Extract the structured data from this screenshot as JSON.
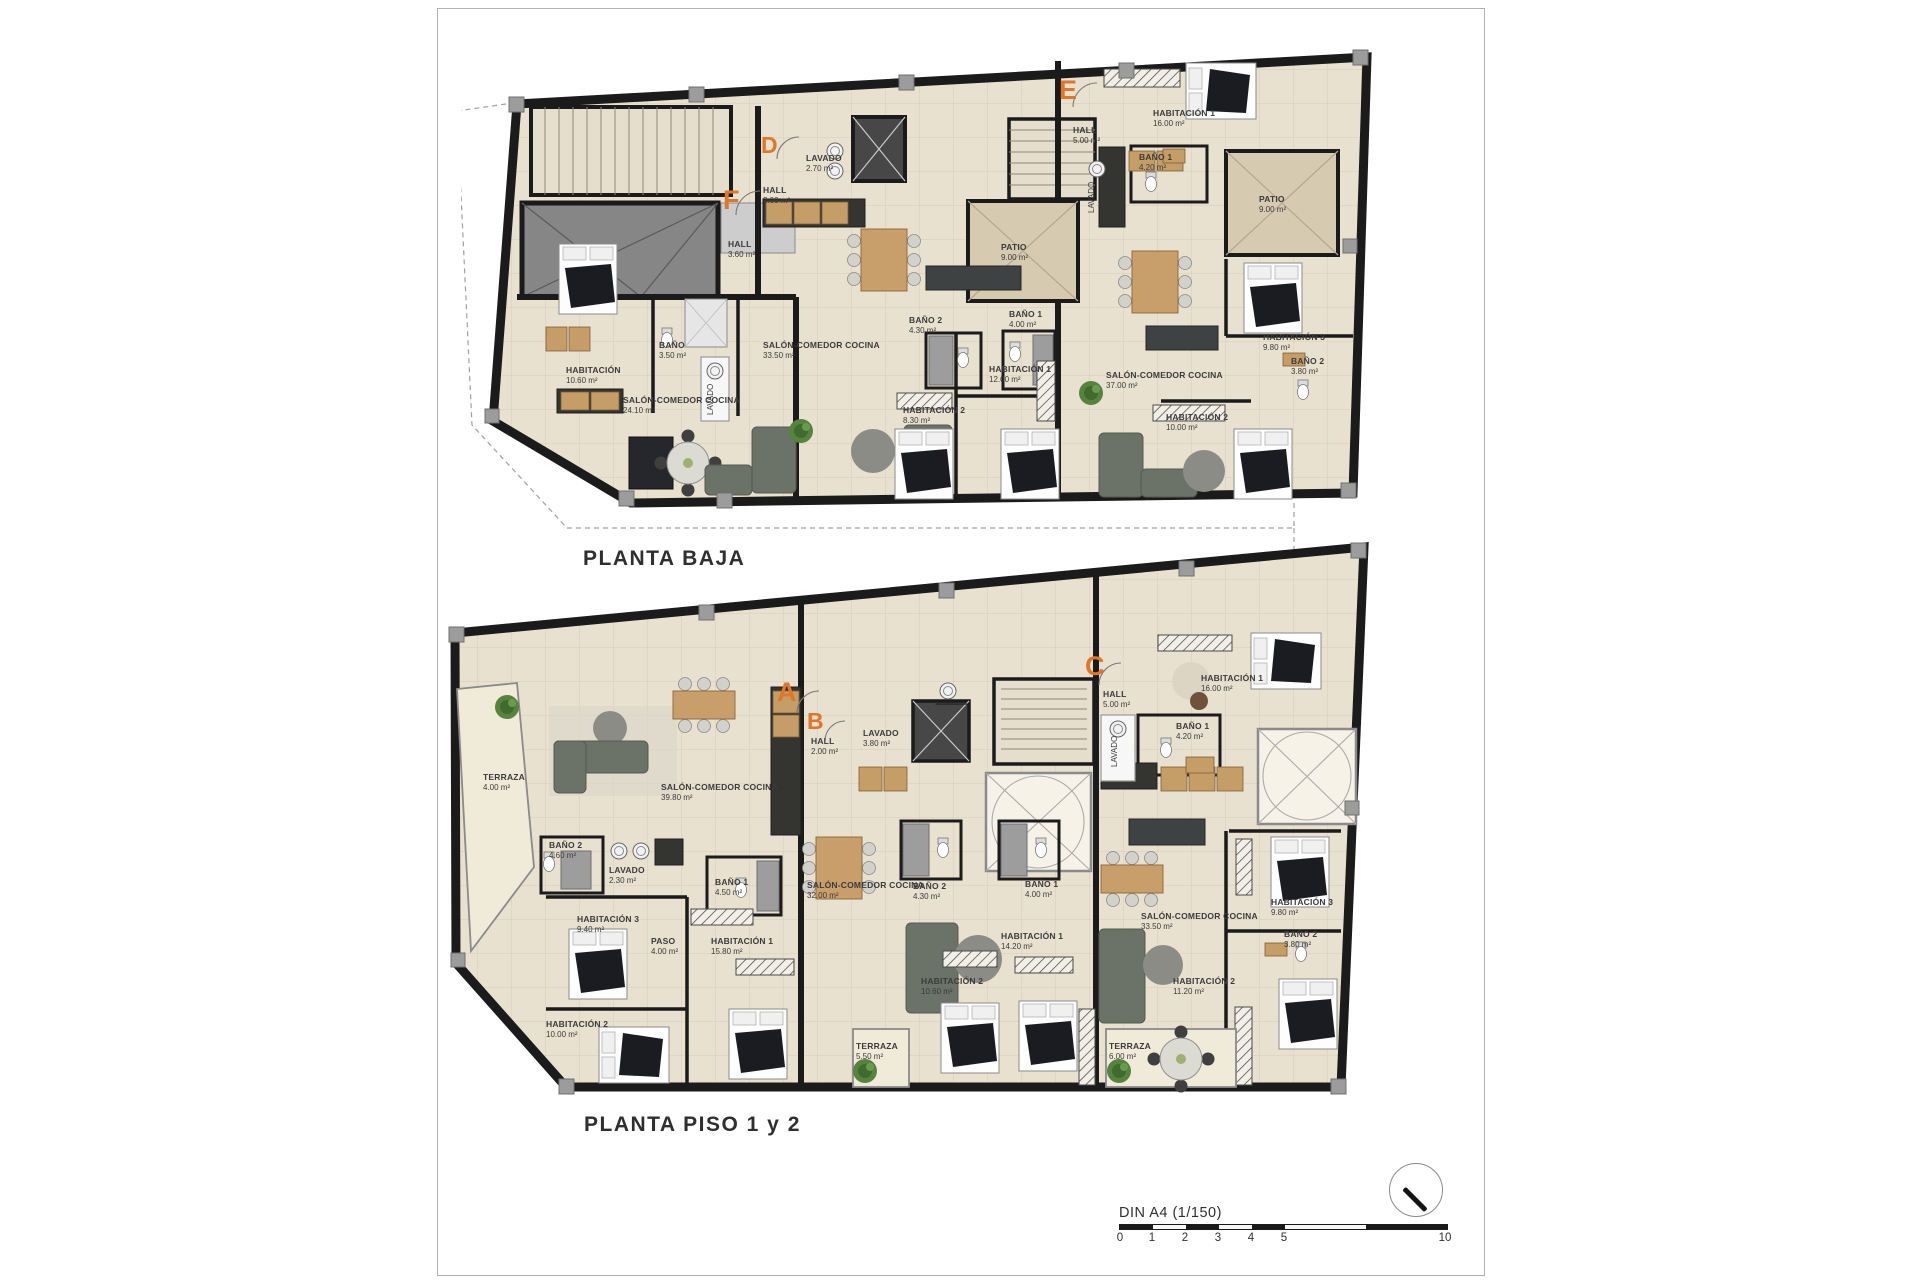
{
  "scale": {
    "label": "DIN A4 (1/150)",
    "ticks": [
      "0",
      "1",
      "2",
      "3",
      "4",
      "5",
      "10"
    ]
  },
  "planta_baja": {
    "title": "PLANTA BAJA",
    "letters": [
      "F",
      "D",
      "E"
    ],
    "rooms": [
      {
        "name": "LAVADO",
        "area": "2.70 m²"
      },
      {
        "name": "HALL",
        "area": "2.00 m²"
      },
      {
        "name": "HALL",
        "area": "3.60 m²"
      },
      {
        "name": "BAÑO",
        "area": "3.50 m²"
      },
      {
        "name": "LAVADO",
        "area": ""
      },
      {
        "name": "HABITACIÓN",
        "area": "10.60 m²"
      },
      {
        "name": "SALÓN-COMEDOR COCINA",
        "area": "24.10 m²"
      },
      {
        "name": "SALÓN-COMEDOR COCINA",
        "area": "33.50 m²"
      },
      {
        "name": "BAÑO 2",
        "area": "4.30 m²"
      },
      {
        "name": "BAÑO 1",
        "area": "4.00 m²"
      },
      {
        "name": "HABITACIÓN 1",
        "area": "12.00 m²"
      },
      {
        "name": "HABITACIÓN 2",
        "area": "8.30 m²"
      },
      {
        "name": "PATIO",
        "area": "9.00 m²"
      },
      {
        "name": "HALL",
        "area": "5.00 m²"
      },
      {
        "name": "HABITACIÓN 1",
        "area": "16.00 m²"
      },
      {
        "name": "BAÑO 1",
        "area": "4.20 m²"
      },
      {
        "name": "PATIO",
        "area": "9.00 m²"
      },
      {
        "name": "SALÓN-COMEDOR COCINA",
        "area": "37.00 m²"
      },
      {
        "name": "HABITACIÓN 3",
        "area": "9.80 m²"
      },
      {
        "name": "BAÑO 2",
        "area": "3.80 m²"
      },
      {
        "name": "HABITACIÓN 2",
        "area": "10.00 m²"
      },
      {
        "name": "LAVADO",
        "area": ""
      }
    ]
  },
  "planta_piso": {
    "title": "PLANTA PISO 1 y 2",
    "letters": [
      "A",
      "B",
      "C"
    ],
    "rooms": [
      {
        "name": "TERRAZA",
        "area": "4.00 m²"
      },
      {
        "name": "SALÓN-COMEDOR COCINA",
        "area": "39.80 m²"
      },
      {
        "name": "BAÑO 2",
        "area": "4.60 m²"
      },
      {
        "name": "LAVADO",
        "area": "2.30 m²"
      },
      {
        "name": "BAÑO 1",
        "area": "4.50 m²"
      },
      {
        "name": "HABITACIÓN 3",
        "area": "9.40 m²"
      },
      {
        "name": "PASO",
        "area": "4.00 m²"
      },
      {
        "name": "HABITACIÓN 1",
        "area": "15.80 m²"
      },
      {
        "name": "HABITACIÓN 2",
        "area": "10.00 m²"
      },
      {
        "name": "HALL",
        "area": "2.00 m²"
      },
      {
        "name": "LAVADO",
        "area": "3.80 m²"
      },
      {
        "name": "SALÓN-COMEDOR COCINA",
        "area": "32.00 m²"
      },
      {
        "name": "BAÑO 2",
        "area": "4.30 m²"
      },
      {
        "name": "BAÑO 1",
        "area": "4.00 m²"
      },
      {
        "name": "HABITACIÓN 1",
        "area": "14.20 m²"
      },
      {
        "name": "HABITACIÓN 2",
        "area": "10.60 m²"
      },
      {
        "name": "TERRAZA",
        "area": "5.50 m²"
      },
      {
        "name": "HALL",
        "area": "5.00 m²"
      },
      {
        "name": "HABITACIÓN 1",
        "area": "16.00 m²"
      },
      {
        "name": "BAÑO 1",
        "area": "4.20 m²"
      },
      {
        "name": "SALÓN-COMEDOR COCINA",
        "area": "33.50 m²"
      },
      {
        "name": "HABITACIÓN 3",
        "area": "9.80 m²"
      },
      {
        "name": "BAÑO 2",
        "area": "3.80 m²"
      },
      {
        "name": "HABITACIÓN 2",
        "area": "11.20 m²"
      },
      {
        "name": "TERRAZA",
        "area": "6.00 m²"
      },
      {
        "name": "LAVADO",
        "area": ""
      }
    ]
  }
}
